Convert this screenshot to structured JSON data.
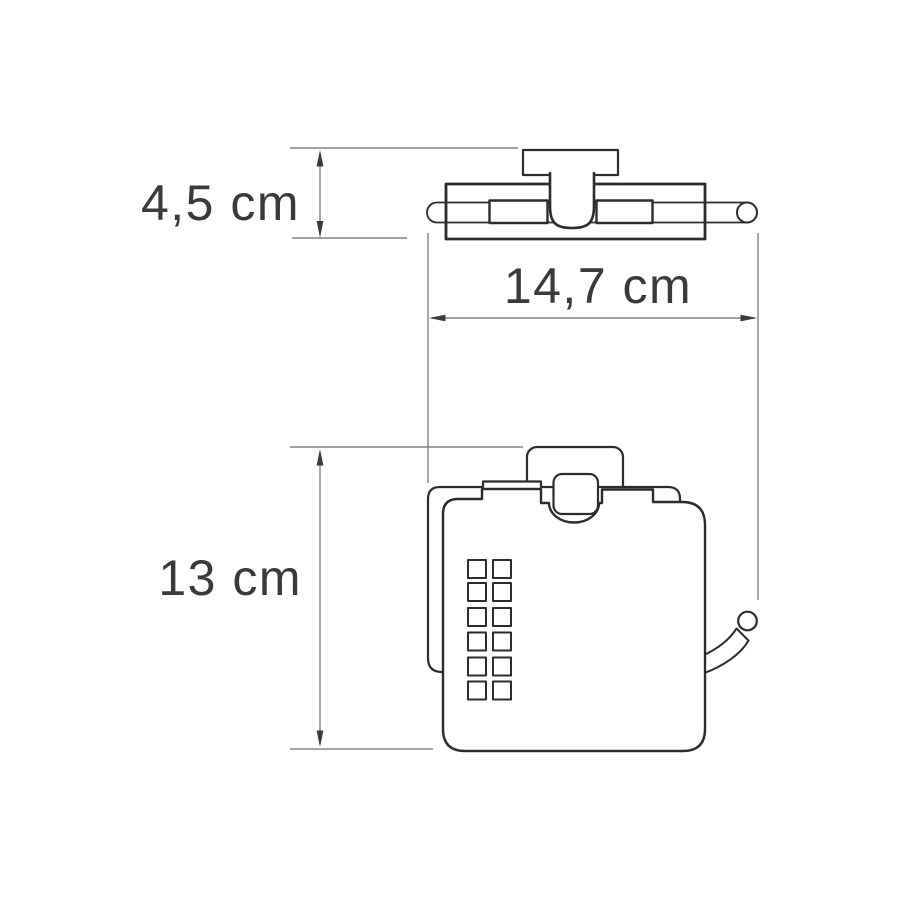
{
  "page": {
    "type": "technical dimension drawing",
    "subject": "wall-mounted covered toilet paper holder",
    "background": "#ffffff"
  },
  "views": {
    "top_view": "holder seen from above",
    "front_view": "holder seen from front"
  },
  "dimensions": {
    "depth": {
      "label": "4,5 cm",
      "value": "4,5",
      "unit": "cm",
      "orientation": "vertical",
      "applies_to": "top view depth"
    },
    "width": {
      "label": "14,7 cm",
      "value": "14,7",
      "unit": "cm",
      "orientation": "horizontal",
      "applies_to": "overall width"
    },
    "height": {
      "label": "13 cm",
      "value": "13",
      "unit": "cm",
      "orientation": "vertical",
      "applies_to": "front view height"
    }
  },
  "colors": {
    "outline": "#2c2c2c",
    "dimension_line": "#848484",
    "arrowhead": "#3c3c3c",
    "label_text": "#3a3a3a",
    "background": "#ffffff"
  }
}
